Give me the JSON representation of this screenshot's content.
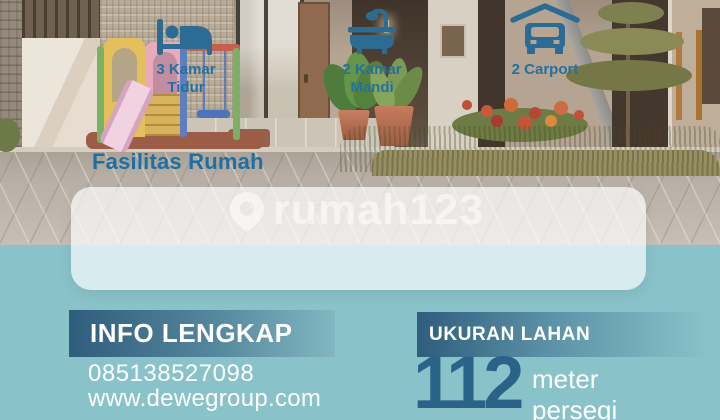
{
  "section_title": "Fasilitas Rumah",
  "watermark": {
    "icon": "rumah123-pin-icon",
    "text": "rumah123"
  },
  "facilities": [
    {
      "icon": "bed-icon",
      "line1": "3 Kamar",
      "line2": "Tidur"
    },
    {
      "icon": "bathtub-icon",
      "line1": "2 Kamar",
      "line2": "Mandi"
    },
    {
      "icon": "carport-icon",
      "line1": "2 Carport",
      "line2": ""
    }
  ],
  "info": {
    "heading": "INFO LENGKAP",
    "phone": "085138527098",
    "website": "www.dewegroup.com"
  },
  "land_size": {
    "heading": "UKURAN LAHAN",
    "value": "112",
    "unit_line1": "meter",
    "unit_line2": "persegi"
  },
  "colors": {
    "accent_blue": "#1e6fa3",
    "icon_blue": "#2b6b94",
    "value_blue": "#2b6388",
    "teal_background": "#8ac2c9",
    "bar_gradient_dark": "#2f5d7c",
    "text_white": "#ffffff"
  }
}
